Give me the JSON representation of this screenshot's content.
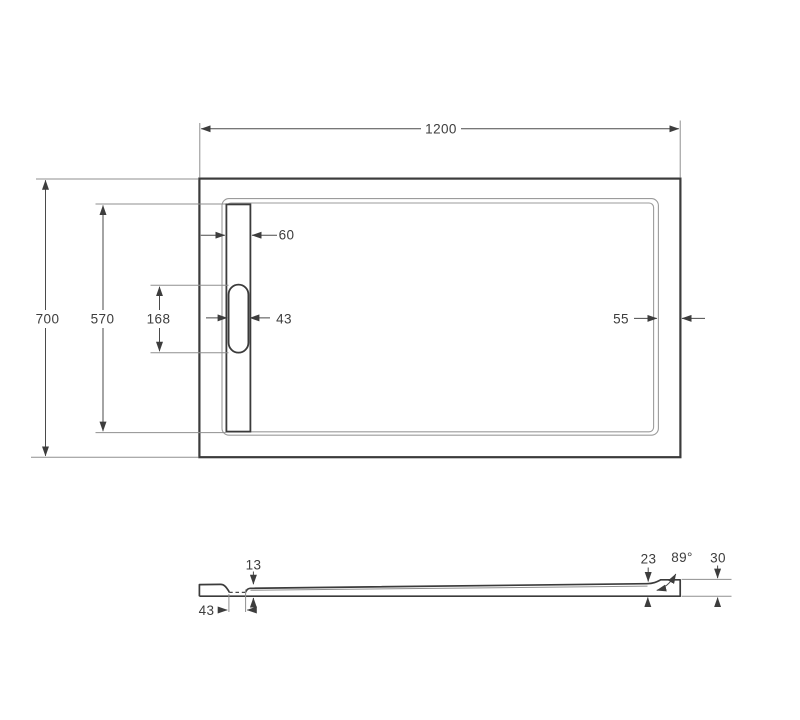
{
  "drawing": {
    "type": "technical-dimension-drawing",
    "subject": "rectangular shower tray with linear drain, top view and side section view",
    "colors": {
      "background": "#ffffff",
      "outline_dark": "#3b3b3b",
      "outline_thin": "#9b9b9b",
      "dimension": "#4a4a4a",
      "label_text": "#3d3d3d"
    },
    "top_view": {
      "overall_width": "1200",
      "overall_depth": "700",
      "basin_depth": "570",
      "drain_cover_length": "168",
      "drain_channel_width": "60",
      "drain_cover_width": "43",
      "rim_width": "55"
    },
    "side_view": {
      "tray_thickness": "13",
      "drain_channel_length": "43",
      "edge_height": "23",
      "wall_angle": "89°",
      "total_height": "30"
    }
  }
}
